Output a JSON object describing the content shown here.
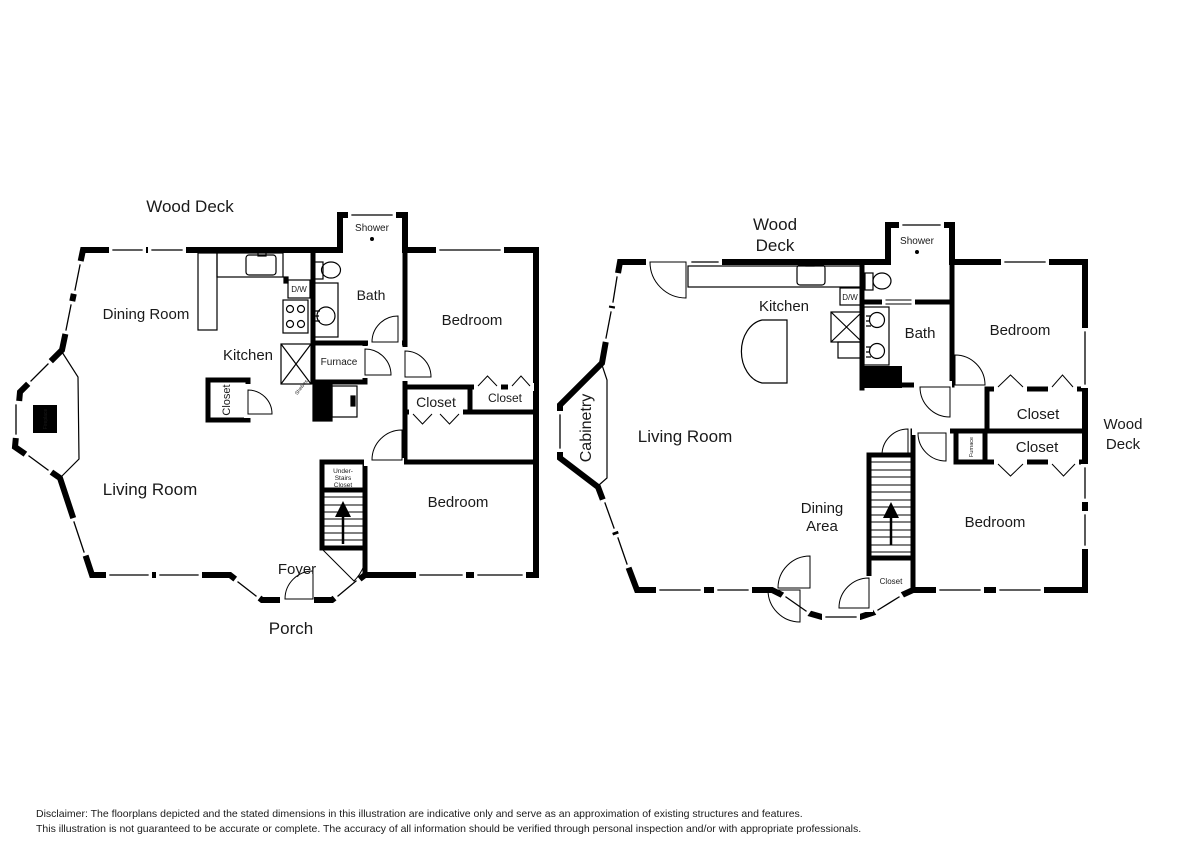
{
  "colors": {
    "wall": "#000000",
    "text": "#1a1a1a",
    "fireplace_text": "#ffffff",
    "disclaimer": "#a9b5c3"
  },
  "plan1": {
    "deck": "Wood Deck",
    "rooms": {
      "dining": "Dining Room",
      "kitchen": "Kitchen",
      "living": "Living Room",
      "bath": "Bath",
      "shower": "Shower",
      "bedroom_upper": "Bedroom",
      "bedroom_lower": "Bedroom",
      "foyer": "Foyer",
      "porch": "Porch"
    },
    "features": {
      "dw": "D/W",
      "furnace": "Furnace",
      "shelves": "Shelves",
      "fireplace": "Fireplace",
      "closet_kitchen": "Closet",
      "closet_hall": "Closet",
      "closet_bedroom": "Closet",
      "understairs": [
        "Under-",
        "Stairs",
        "Closet"
      ]
    }
  },
  "plan2": {
    "deck_top": [
      "Wood",
      "Deck"
    ],
    "deck_right": [
      "Wood",
      "Deck"
    ],
    "rooms": {
      "kitchen": "Kitchen",
      "living": "Living Room",
      "dining": [
        "Dining",
        "Area"
      ],
      "bath": "Bath",
      "shower": "Shower",
      "bedroom_upper": "Bedroom",
      "bedroom_lower": "Bedroom"
    },
    "features": {
      "dw": "D/W",
      "furnace": "Furnace",
      "cabinetry": "Cabinetry",
      "closet_1": "Closet",
      "closet_2": "Closet",
      "closet_stairs": "Closet"
    }
  },
  "disclaimer": {
    "line1": "Disclaimer: The floorplans depicted and the stated dimensions in this illustration are indicative only and serve as an approximation of existing structures and features.",
    "line2": "This illustration is not guaranteed to be accurate or complete. The accuracy of all information should be verified through personal inspection and/or with appropriate professionals."
  }
}
